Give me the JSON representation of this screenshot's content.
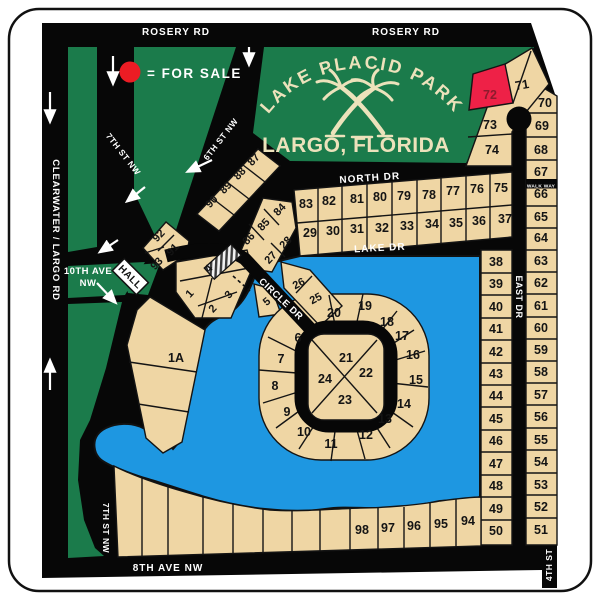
{
  "title": {
    "park_name": "LAKE PLACID PARK",
    "city": "LARGO, FLORIDA"
  },
  "legend": {
    "for_sale_label": "= FOR  SALE"
  },
  "for_sale_lots": [
    "72"
  ],
  "streets": {
    "rosery_left": "ROSERY RD",
    "rosery_right": "ROSERY RD",
    "clearwater": "CLEARWATER / LARGO RD",
    "seventh_top": "7TH ST NW",
    "sixth": "6TH ST NW",
    "tenth_line1": "10TH  AVE",
    "tenth_line2": "NW",
    "hall": "HALL",
    "north": "NORTH  DR",
    "lake": "LAKE  DR",
    "circle": "CIRCLE  DR",
    "east": "EAST  DR",
    "walkway": "WALK  WAY",
    "seventh_bottom": "7TH ST NW",
    "eighth": "8TH  AVE  NW",
    "fourth": "4TH  ST"
  },
  "colors": {
    "park_green": "#1b7b4b",
    "lot_tan": "#efd6a4",
    "water_blue": "#1e97e1",
    "road_black": "#070707",
    "for_sale_red": "#ee2147",
    "title_cream": "#ece2bb"
  },
  "lots": {
    "1A": "1A",
    "1": "1",
    "2": "2",
    "3": "3",
    "4": "4",
    "5": "5",
    "6": "6",
    "7": "7",
    "8": "8",
    "9": "9",
    "10": "10",
    "11": "11",
    "12": "12",
    "13": "13",
    "14": "14",
    "15": "15",
    "16": "16",
    "17": "17",
    "18": "18",
    "19": "19",
    "20": "20",
    "21": "21",
    "22": "22",
    "23": "23",
    "24": "24",
    "25": "25",
    "26": "26",
    "27": "27",
    "28": "28",
    "29": "29",
    "30": "30",
    "31": "31",
    "32": "32",
    "33": "33",
    "34": "34",
    "35": "35",
    "36": "36",
    "37": "37",
    "38": "38",
    "39": "39",
    "40": "40",
    "41": "41",
    "42": "42",
    "43": "43",
    "44": "44",
    "45": "45",
    "46": "46",
    "47": "47",
    "48": "48",
    "49": "49",
    "50": "50",
    "51": "51",
    "52": "52",
    "53": "53",
    "54": "54",
    "55": "55",
    "56": "56",
    "57": "57",
    "58": "58",
    "59": "59",
    "60": "60",
    "61": "61",
    "62": "62",
    "63": "63",
    "64": "64",
    "65": "65",
    "66": "66",
    "67": "67",
    "68": "68",
    "69": "69",
    "70": "70",
    "71": "71",
    "72": "72",
    "73": "73",
    "74": "74",
    "75": "75",
    "76": "76",
    "77": "77",
    "78": "78",
    "79": "79",
    "80": "80",
    "81": "81",
    "82": "82",
    "83": "83",
    "84": "84",
    "85": "85",
    "86": "86",
    "87": "87",
    "88": "88",
    "89": "89",
    "90": "90",
    "91": "91",
    "92": "92",
    "93": "93",
    "94": "94",
    "95": "95",
    "96": "96",
    "97": "97",
    "98": "98"
  }
}
